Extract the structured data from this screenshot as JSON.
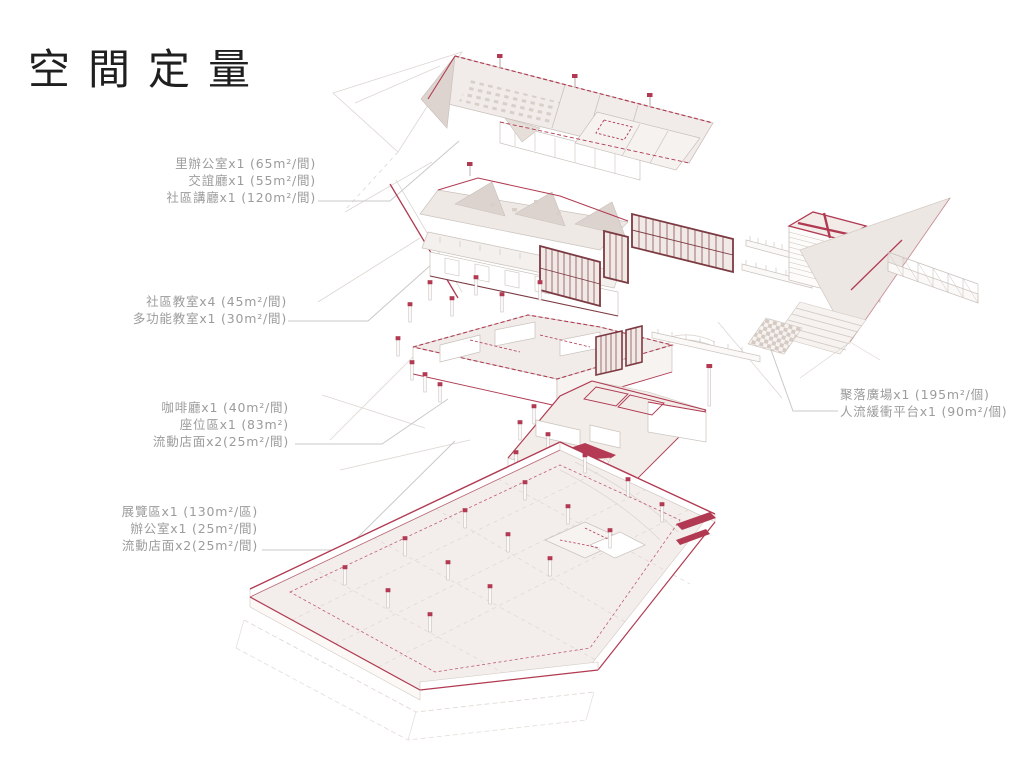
{
  "title": "空間定量",
  "colors": {
    "accent_red": "#b13a52",
    "dark_red": "#7c3a42",
    "line_gray": "#c9c1bb",
    "label_gray": "#9c9c9c",
    "title_black": "#1f1f1f"
  },
  "labels": {
    "groups": [
      {
        "id": "community-office",
        "side": "left",
        "lines": [
          "里辦公室x1 (65m²/間)",
          "交誼廳x1 (55m²/間)",
          "社區講廳x1 (120m²/間)"
        ]
      },
      {
        "id": "classrooms",
        "side": "left",
        "lines": [
          "社區教室x4 (45m²/間)",
          "多功能教室x1 (30m²/間)"
        ]
      },
      {
        "id": "cafe",
        "side": "left",
        "lines": [
          "咖啡廳x1 (40m²/間)",
          "座位區x1 (83m²)",
          "流動店面x2(25m²/間)"
        ]
      },
      {
        "id": "exhibition",
        "side": "left",
        "lines": [
          "展覽區x1 (130m²/區)",
          "辦公室x1 (25m²/間)",
          "流動店面x2(25m²/間)"
        ]
      },
      {
        "id": "plaza",
        "side": "right",
        "lines": [
          "聚落廣場x1 (195m²/個)",
          "人流緩衝平台x1 (90m²/個)"
        ]
      }
    ]
  }
}
